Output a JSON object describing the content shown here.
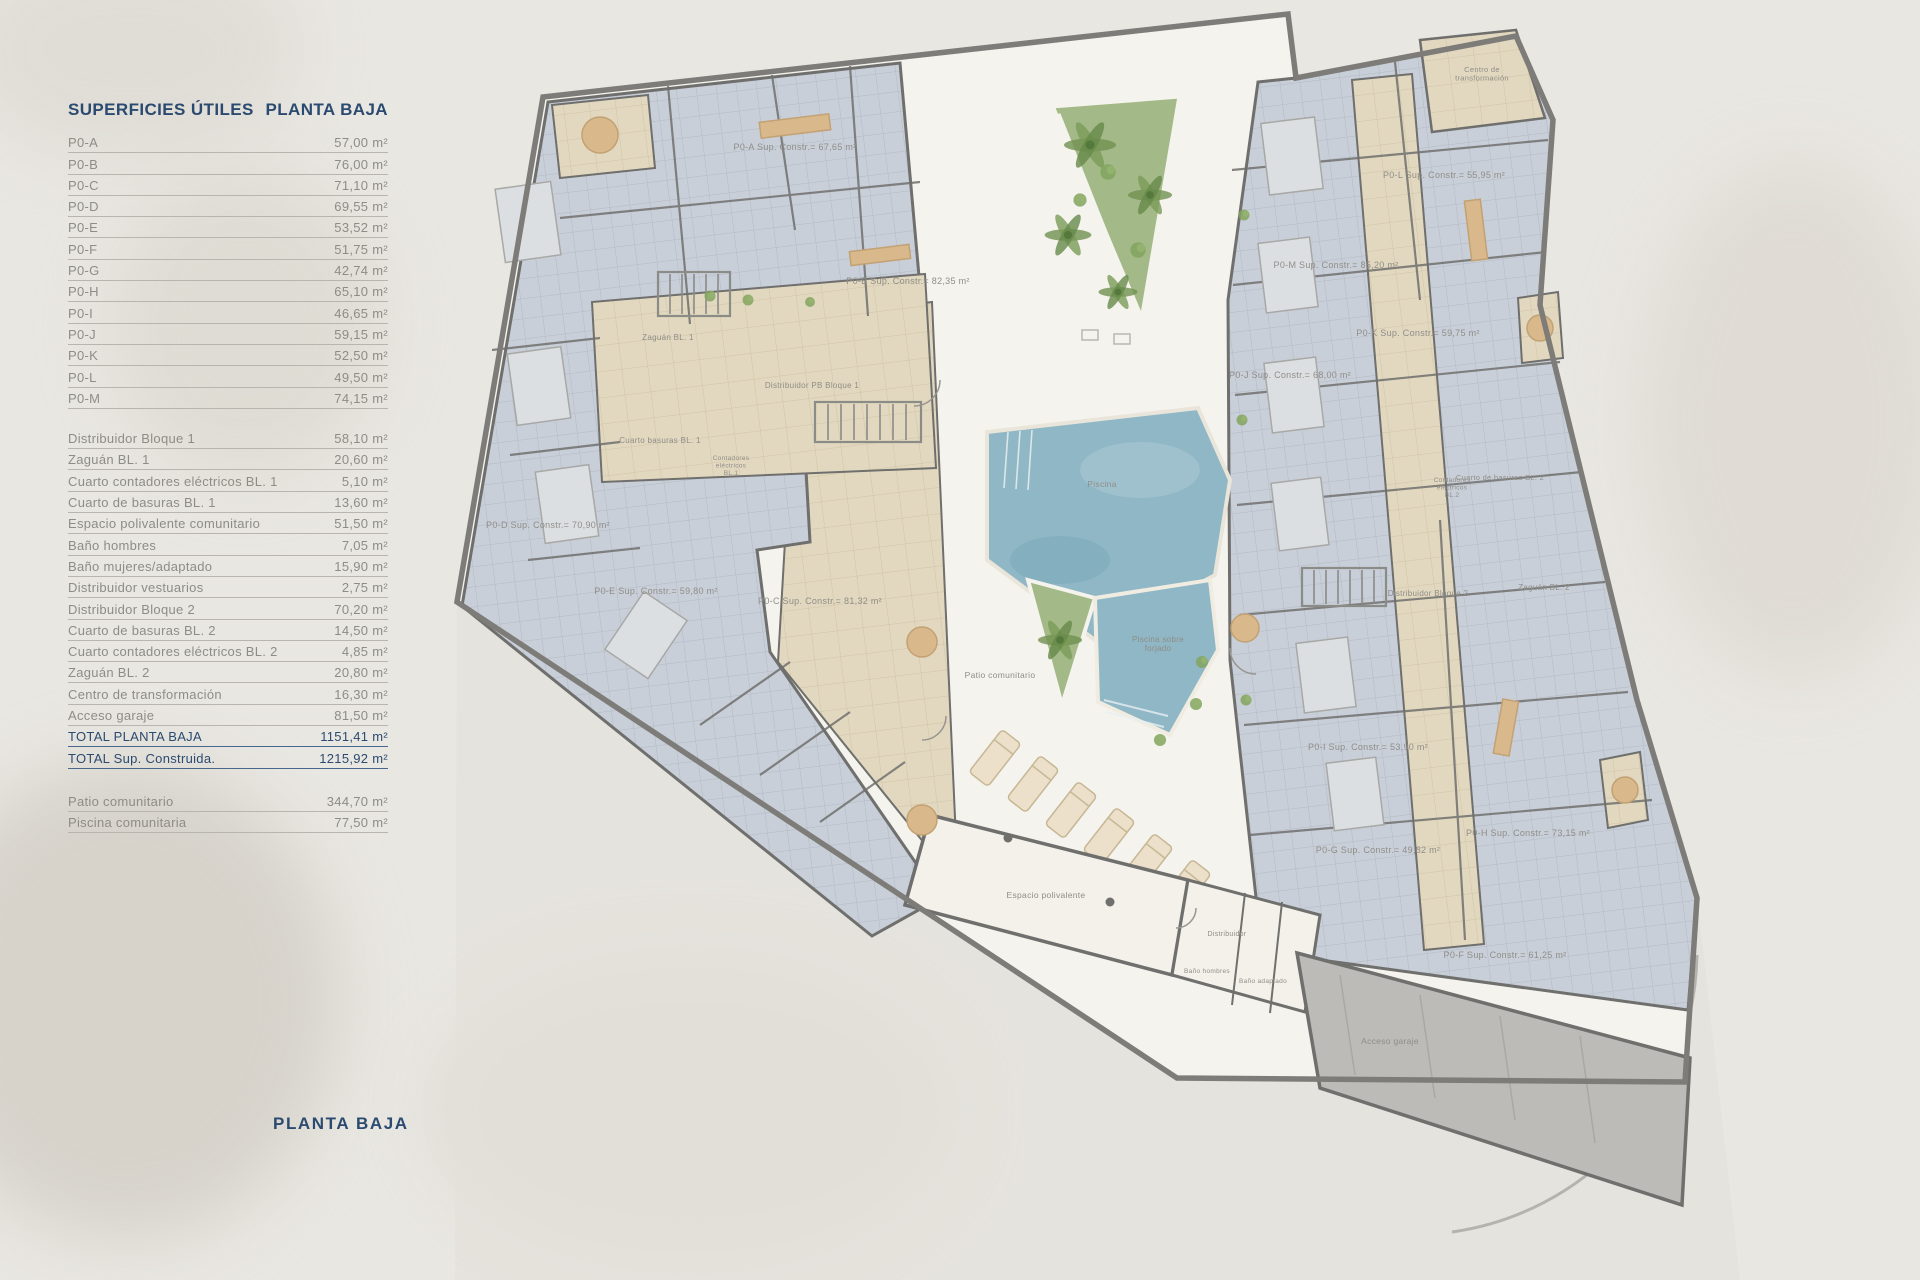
{
  "palette": {
    "page_bg": "#e9e7e2",
    "navy": "#2b4a70",
    "gray_text": "#8e8c86",
    "row_line": "#b8b5ae",
    "wall": "#6f6f6d",
    "outline": "#7d7c78",
    "tile_blue": "#c9cfd8",
    "beige": "#e2d8bf",
    "courtyard": "#f5f3ed",
    "pool": "#8fb7c5",
    "garden": "#a3ba88",
    "garage": "#bdbbb8",
    "tan": "#d9b98c"
  },
  "sidebar": {
    "title_left": "SUPERFICIES ÚTILES",
    "title_right": "PLANTA BAJA",
    "apartments": [
      {
        "label": "P0-A",
        "value": "57,00 m²"
      },
      {
        "label": "P0-B",
        "value": "76,00 m²"
      },
      {
        "label": "P0-C",
        "value": "71,10 m²"
      },
      {
        "label": "P0-D",
        "value": "69,55 m²"
      },
      {
        "label": "P0-E",
        "value": "53,52 m²"
      },
      {
        "label": "P0-F",
        "value": "51,75 m²"
      },
      {
        "label": "P0-G",
        "value": "42,74 m²"
      },
      {
        "label": "P0-H",
        "value": "65,10 m²"
      },
      {
        "label": "P0-I",
        "value": "46,65 m²"
      },
      {
        "label": "P0-J",
        "value": "59,15 m²"
      },
      {
        "label": "P0-K",
        "value": "52,50 m²"
      },
      {
        "label": "P0-L",
        "value": "49,50 m²"
      },
      {
        "label": "P0-M",
        "value": "74,15 m²"
      }
    ],
    "common": [
      {
        "label": "Distribuidor Bloque 1",
        "value": "58,10 m²"
      },
      {
        "label": "Zaguán BL. 1",
        "value": "20,60 m²"
      },
      {
        "label": "Cuarto contadores eléctricos BL. 1",
        "value": "5,10 m²"
      },
      {
        "label": "Cuarto de basuras BL. 1",
        "value": "13,60 m²"
      },
      {
        "label": "Espacio polivalente comunitario",
        "value": "51,50 m²"
      },
      {
        "label": "Baño hombres",
        "value": "7,05 m²"
      },
      {
        "label": "Baño mujeres/adaptado",
        "value": "15,90 m²"
      },
      {
        "label": "Distribuidor vestuarios",
        "value": "2,75 m²"
      },
      {
        "label": "Distribuidor Bloque 2",
        "value": "70,20 m²"
      },
      {
        "label": "Cuarto de basuras BL. 2",
        "value": "14,50 m²"
      },
      {
        "label": "Cuarto contadores eléctricos BL. 2",
        "value": "4,85 m²"
      },
      {
        "label": "Zaguán BL. 2",
        "value": "20,80 m²"
      },
      {
        "label": "Centro de transformación",
        "value": "16,30 m²"
      },
      {
        "label": "Acceso garaje",
        "value": "81,50 m²"
      }
    ],
    "totals": [
      {
        "label": "TOTAL PLANTA BAJA",
        "value": "1151,41 m²"
      },
      {
        "label": "TOTAL Sup. Construida.",
        "value": "1215,92 m²"
      }
    ],
    "outdoor": [
      {
        "label": "Patio comunitario",
        "value": "344,70 m²"
      },
      {
        "label": "Piscina comunitaria",
        "value": "77,50 m²"
      }
    ],
    "footer_title": "PLANTA BAJA"
  },
  "plan": {
    "unit_labels": [
      {
        "text": "P0-A Sup. Constr.= 67,65 m²",
        "x": 795,
        "y": 150
      },
      {
        "text": "P0-B Sup. Constr.= 82,35 m²",
        "x": 908,
        "y": 284
      },
      {
        "text": "P0-C Sup. Constr.= 81,32 m²",
        "x": 820,
        "y": 604
      },
      {
        "text": "P0-D Sup. Constr.= 70,90 m²",
        "x": 548,
        "y": 528
      },
      {
        "text": "P0-E Sup. Constr.= 59,80 m²",
        "x": 656,
        "y": 594
      },
      {
        "text": "P0-F Sup. Constr.= 61,25 m²",
        "x": 1505,
        "y": 958
      },
      {
        "text": "P0-G Sup. Constr.= 49,82 m²",
        "x": 1378,
        "y": 853
      },
      {
        "text": "P0-H Sup. Constr.= 73,15 m²",
        "x": 1528,
        "y": 836
      },
      {
        "text": "P0-I Sup. Constr.= 53,90 m²",
        "x": 1368,
        "y": 750
      },
      {
        "text": "P0-J Sup. Constr.= 68,00 m²",
        "x": 1290,
        "y": 378
      },
      {
        "text": "P0-K Sup. Constr.= 59,75 m²",
        "x": 1418,
        "y": 336
      },
      {
        "text": "P0-L Sup. Constr.= 55,95 m²",
        "x": 1444,
        "y": 178
      },
      {
        "text": "P0-M Sup. Constr.= 85,20 m²",
        "x": 1336,
        "y": 268
      }
    ],
    "area_labels": [
      {
        "text": "Zaguán BL. 1",
        "x": 668,
        "y": 340,
        "fs": 8
      },
      {
        "text": "Distribuidor PB Bloque 1",
        "x": 812,
        "y": 388,
        "fs": 8
      },
      {
        "text": "Cuarto basuras BL. 1",
        "x": 660,
        "y": 443,
        "fs": 8
      },
      {
        "lines": [
          "Contadores",
          "eléctricos",
          "BL.1"
        ],
        "x": 731,
        "y": 460,
        "fs": 6.5
      },
      {
        "text": "Cuarto de basuras BL. 2",
        "x": 1500,
        "y": 480,
        "fs": 7.5
      },
      {
        "lines": [
          "Contadores",
          "eléctricos",
          "BL.2"
        ],
        "x": 1452,
        "y": 482,
        "fs": 6.5
      },
      {
        "text": "Distribuidor Bloque 2",
        "x": 1428,
        "y": 596,
        "fs": 8
      },
      {
        "text": "Zaguán BL. 2",
        "x": 1544,
        "y": 590,
        "fs": 8
      },
      {
        "lines": [
          "Centro de",
          "transformación"
        ],
        "x": 1482,
        "y": 72,
        "fs": 7.5
      },
      {
        "text": "Piscina",
        "x": 1102,
        "y": 487,
        "fs": 8.5,
        "c": "#5f8496"
      },
      {
        "lines": [
          "Piscina sobre",
          "forjado"
        ],
        "x": 1158,
        "y": 642,
        "fs": 8,
        "c": "#5f8496"
      },
      {
        "text": "Patio comunitario",
        "x": 1000,
        "y": 678,
        "fs": 8.5
      },
      {
        "text": "Espacio polivalente",
        "x": 1046,
        "y": 898,
        "fs": 8.5
      },
      {
        "text": "Distribuidor",
        "x": 1227,
        "y": 936,
        "fs": 7
      },
      {
        "text": "Baño hombres",
        "x": 1207,
        "y": 973,
        "fs": 6.5
      },
      {
        "text": "Baño adaptado",
        "x": 1263,
        "y": 983,
        "fs": 6.5
      },
      {
        "text": "Acceso garaje",
        "x": 1390,
        "y": 1044,
        "fs": 8.5
      }
    ]
  }
}
